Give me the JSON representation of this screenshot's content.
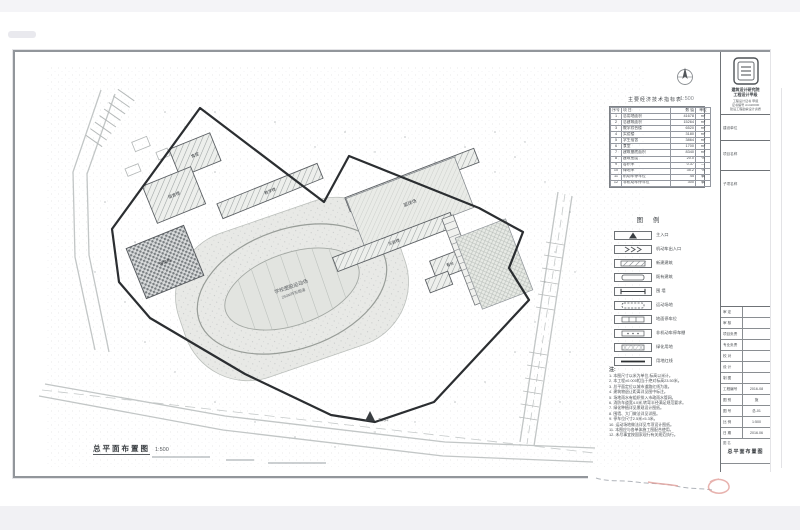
{
  "drawing": {
    "scale_label": "1:500",
    "title": "总平面布置图",
    "title_scale": "1:500",
    "entrance_label": "主入口",
    "track_line1": "学校塑胶运动场",
    "track_line2": "250M环形跑道",
    "labels": {
      "canteen": "食堂",
      "dorm": "宿舍楼",
      "teaching": "教学楼",
      "courtyard": "篮球场",
      "lab": "实验楼",
      "stand": "看台",
      "plaza": "停车场"
    }
  },
  "econ_table": {
    "title": "主要经济技术指标表",
    "headers": [
      "序号",
      "项 目",
      "数 值",
      "单位"
    ],
    "rows": [
      {
        "idx": "1",
        "name": "总用地面积",
        "value": "41678",
        "unit": "m²"
      },
      {
        "idx": "2",
        "name": "总建筑面积",
        "value": "15264",
        "unit": "m²"
      },
      {
        "idx": "3",
        "name": "教学综合楼",
        "value": "6520",
        "unit": "m²"
      },
      {
        "idx": "4",
        "name": "实验楼",
        "value": "3180",
        "unit": "m²"
      },
      {
        "idx": "5",
        "name": "学生宿舍",
        "value": "3864",
        "unit": "m²"
      },
      {
        "idx": "6",
        "name": "食堂",
        "value": "1700",
        "unit": "m²"
      },
      {
        "idx": "7",
        "name": "建筑基底面积",
        "value": "8340",
        "unit": "m²"
      },
      {
        "idx": "8",
        "name": "建筑密度",
        "value": "20.0",
        "unit": "%"
      },
      {
        "idx": "9",
        "name": "容积率",
        "value": "0.37",
        "unit": "—"
      },
      {
        "idx": "10",
        "name": "绿地率",
        "value": "35.2",
        "unit": "%"
      },
      {
        "idx": "11",
        "name": "机动车停车位",
        "value": "45",
        "unit": "辆"
      },
      {
        "idx": "12",
        "name": "非机动车停车位",
        "value": "300",
        "unit": "辆"
      }
    ]
  },
  "legend": {
    "title": "图 例",
    "items": [
      {
        "label": "主入口"
      },
      {
        "label": "机动车出入口"
      },
      {
        "label": "新建建筑"
      },
      {
        "label": "既有建筑"
      },
      {
        "label": "围 墙"
      },
      {
        "label": "运动场地"
      },
      {
        "label": "地面停车位"
      },
      {
        "label": "非机动车停车棚"
      },
      {
        "label": "绿化用地"
      },
      {
        "label": "用地红线"
      }
    ]
  },
  "notes": {
    "title": "注:",
    "lines": [
      "1. 本图尺寸以米为单位,标高以米计。",
      "2. 本工程±0.000相当于绝对标高23.50米。",
      "3. 总平面定位以城市道路红线为准。",
      "4. 建筑物退让距离详见图中标注。",
      "5. 场地雨水有组织排入市政雨水管网。",
      "6. 消防车道宽4.0米,转弯半径满足规范要求。",
      "7. 绿化种植详见景观设计图纸。",
      "8. 围墙、大门做法详见详图。",
      "9. 停车位尺寸2.5米×5.3米。",
      "10. 运动场地做法详见专项设计图纸。",
      "11. 本图应与各单体施工图配合使用。",
      "12. 未尽事宜按国家现行有关规范执行。"
    ]
  },
  "titleblock": {
    "company_line1": "建筑设计研究院",
    "company_line2": "工程设计甲级",
    "cert_lines": [
      "工程设计证书 甲级",
      "证书编号 A1420000",
      "建设工程勘察设计资质"
    ],
    "fields": [
      {
        "label": "建设单位"
      },
      {
        "label": "项目名称"
      },
      {
        "label": "子项名称"
      }
    ],
    "sign_rows": [
      {
        "label": "审 定"
      },
      {
        "label": "审 核"
      },
      {
        "label": "项目负责"
      },
      {
        "label": "专业负责"
      },
      {
        "label": "校 对"
      },
      {
        "label": "设 计"
      },
      {
        "label": "制 图"
      }
    ],
    "info_rows": [
      {
        "label": "工程编号",
        "value": "2016-08"
      },
      {
        "label": "图 别",
        "value": "施"
      },
      {
        "label": "图 号",
        "value": "总-01"
      },
      {
        "label": "比 例",
        "value": "1:500"
      },
      {
        "label": "日 期",
        "value": "2016.06"
      }
    ],
    "figure_label": "图 名",
    "figure_name": "总平面布置图"
  },
  "colors": {
    "boundary": "#2b2e31",
    "building_hatch": "#9ba1a1",
    "watermark_red": "#e09a94"
  }
}
